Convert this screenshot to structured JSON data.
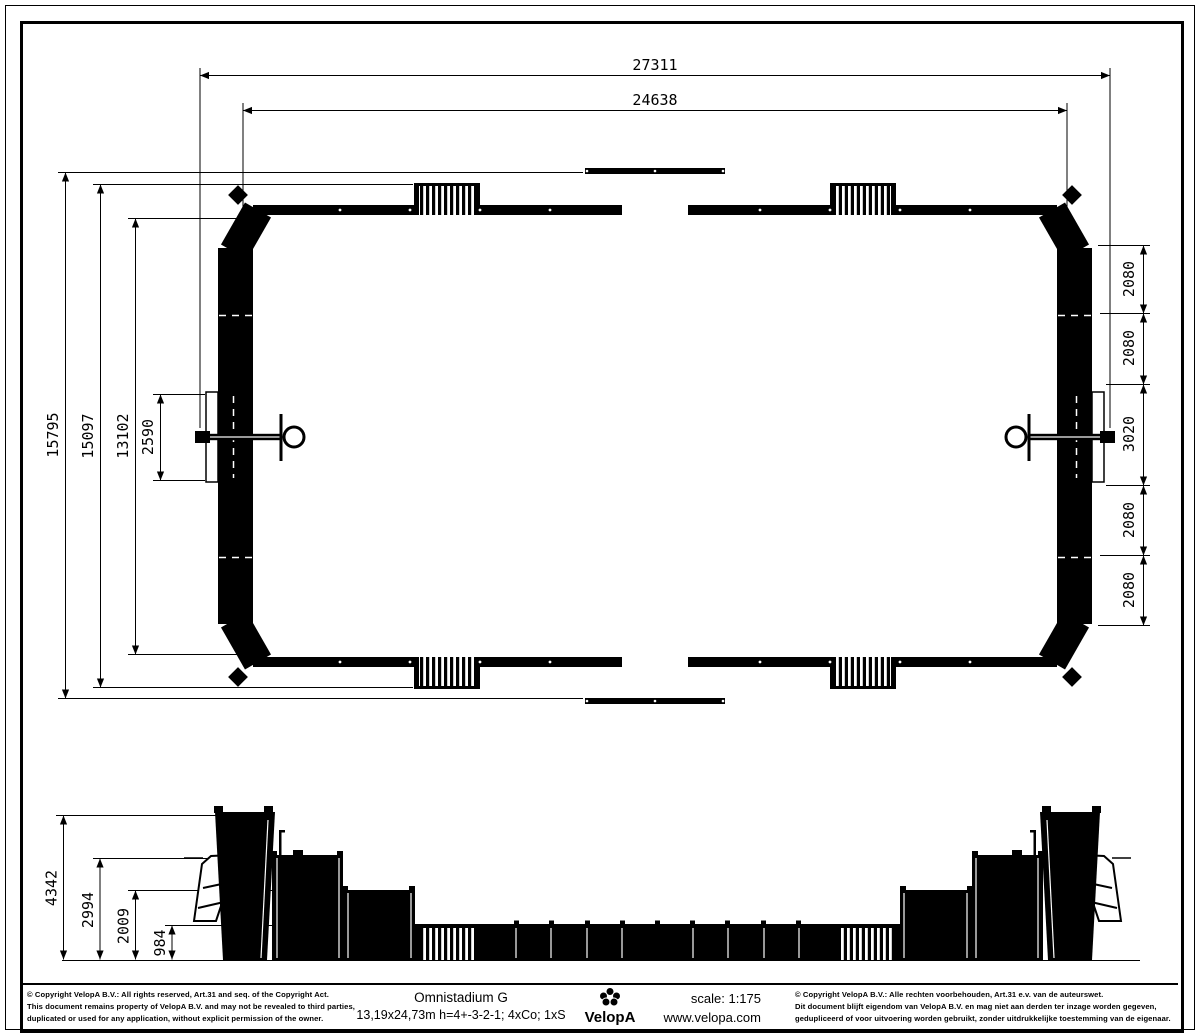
{
  "plan": {
    "dim_overall_width": "27311",
    "dim_frame_width": "24638",
    "dim_overall_depth": "15795",
    "dim_stand_depth": "15097",
    "dim_inner_depth": "13102",
    "dim_goal_panel": "2590",
    "dim_side_panels": [
      "2080",
      "2080",
      "3020",
      "2080",
      "2080"
    ]
  },
  "elevation": {
    "dim_heights": [
      "4342",
      "2994",
      "2009",
      "984"
    ]
  },
  "footer": {
    "copyright_left_lines": [
      "© Copyright VelopA B.V.: All rights reserved, Art.31 and seq. of the Copyright Act.",
      "This document remains property of VelopA B.V. and may not be revealed to third parties,",
      "duplicated or used for any application, without explicit permission of the owner."
    ],
    "product_title": "Omnistadium G",
    "product_spec": "13,19x24,73m h=4+-3-2-1; 4xCo; 1xS",
    "logo_text": "VelopA",
    "scale_label": "scale: 1:175",
    "website": "www.velopa.com",
    "copyright_right_lines": [
      "© Copyright VelopA B.V.: Alle rechten voorbehouden, Art.31 e.v. van de auteurswet.",
      "Dit document blijft eigendom van VelopA B.V. en mag niet aan derden ter inzage worden gegeven,",
      "gedupliceerd of voor uitvoering worden gebruikt, zonder uitdrukkelijke toestemming van de eigenaar."
    ]
  }
}
